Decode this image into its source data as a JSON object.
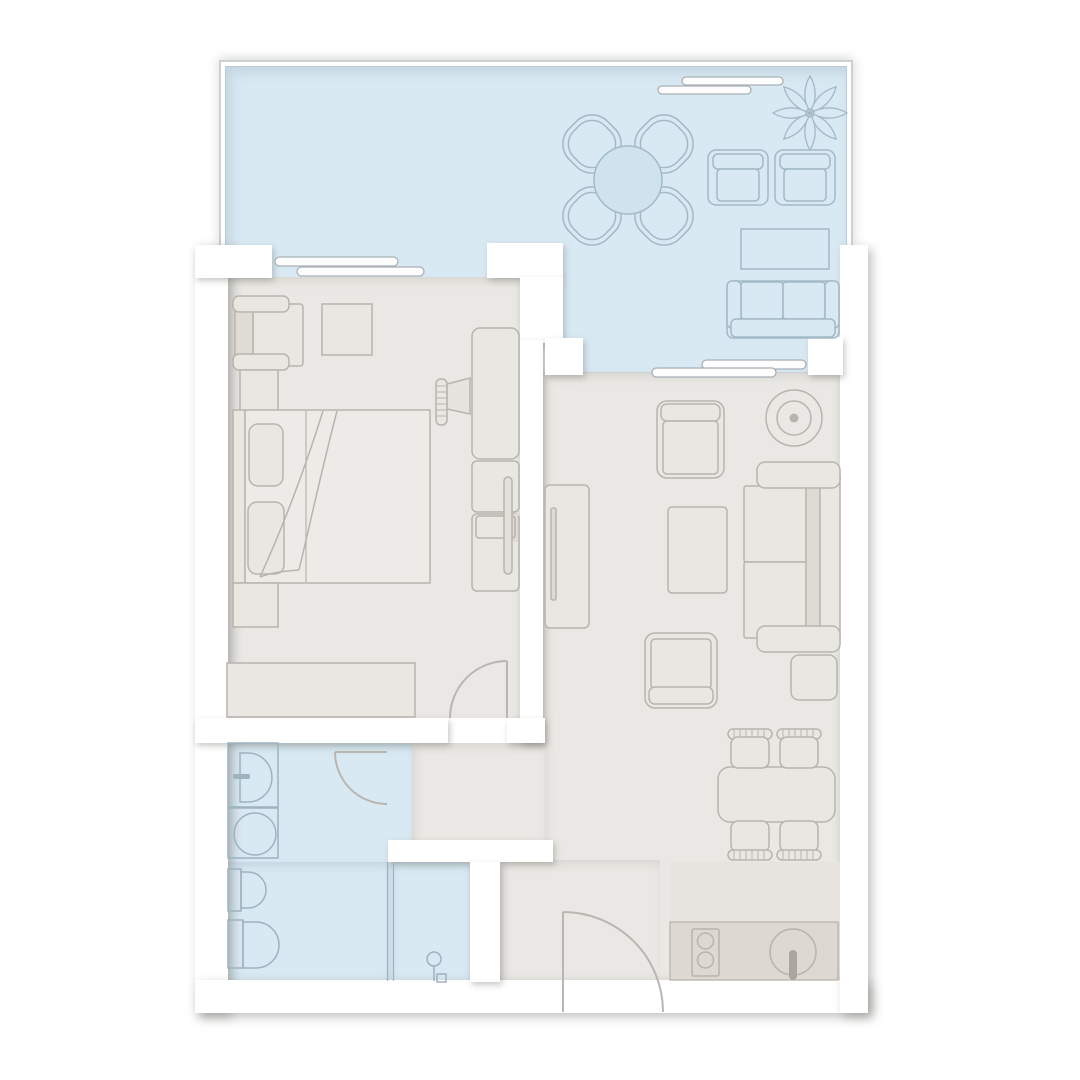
{
  "app": {
    "type": "floor-plan",
    "description": "apartment floor plan, no text labels rendered"
  },
  "colors": {
    "wall": "#ffffff",
    "floor": "#eae8e4",
    "water": "#d9e9f3",
    "outline-warm": "#b8b4ad",
    "outline-cool": "#a3b9c6",
    "outline-fixture": "#9db3bf",
    "door-stroke": "#b9b6b1",
    "counter-light": "#e7e3de",
    "counter-dark": "#ddd8d2",
    "panel-fill": "#fdfdfd",
    "railing": "#cbd0d3"
  },
  "rooms": [
    {
      "id": "balcony",
      "kind": "balcony-terrace",
      "furniture": [
        "garden-clover-table",
        "flower-plant",
        "patio-chair",
        "patio-chair",
        "patio-table",
        "patio-sofa"
      ]
    },
    {
      "id": "bedroom",
      "kind": "bedroom",
      "furniture": [
        "armchair",
        "square-ottoman",
        "nightstand",
        "double-bed",
        "pillow",
        "pillow",
        "dresser-bench",
        "tv-on-stand",
        "wardrobe-column"
      ]
    },
    {
      "id": "living-room",
      "kind": "living-room-with-kitchen",
      "furniture": [
        "tv-sideboard",
        "armchair-top",
        "round-side-table",
        "sectional-sofa",
        "footstool",
        "coffee-table",
        "armchair-bottom",
        "dining-table",
        "dining-chair",
        "dining-chair",
        "dining-chair",
        "dining-chair",
        "kitchen-counter",
        "cooktop-2-burners",
        "kitchen-round-sink"
      ]
    },
    {
      "id": "bathroom",
      "kind": "bathroom",
      "fixtures": [
        "washing-machine",
        "washbasin",
        "toilet",
        "bidet",
        "shower-cabin",
        "glass-partition"
      ]
    },
    {
      "id": "hallway",
      "kind": "entry-hallway",
      "furniture": []
    }
  ],
  "doors": [
    {
      "id": "bedroom-door",
      "swing": "into-bedroom"
    },
    {
      "id": "bathroom-door",
      "swing": "into-bathroom"
    },
    {
      "id": "entry-door",
      "swing": "into-apartment"
    }
  ],
  "windows": {
    "sliding_panel_count": 6,
    "locations": [
      "bedroom-to-balcony",
      "living-to-balcony",
      "balcony-railing"
    ]
  }
}
